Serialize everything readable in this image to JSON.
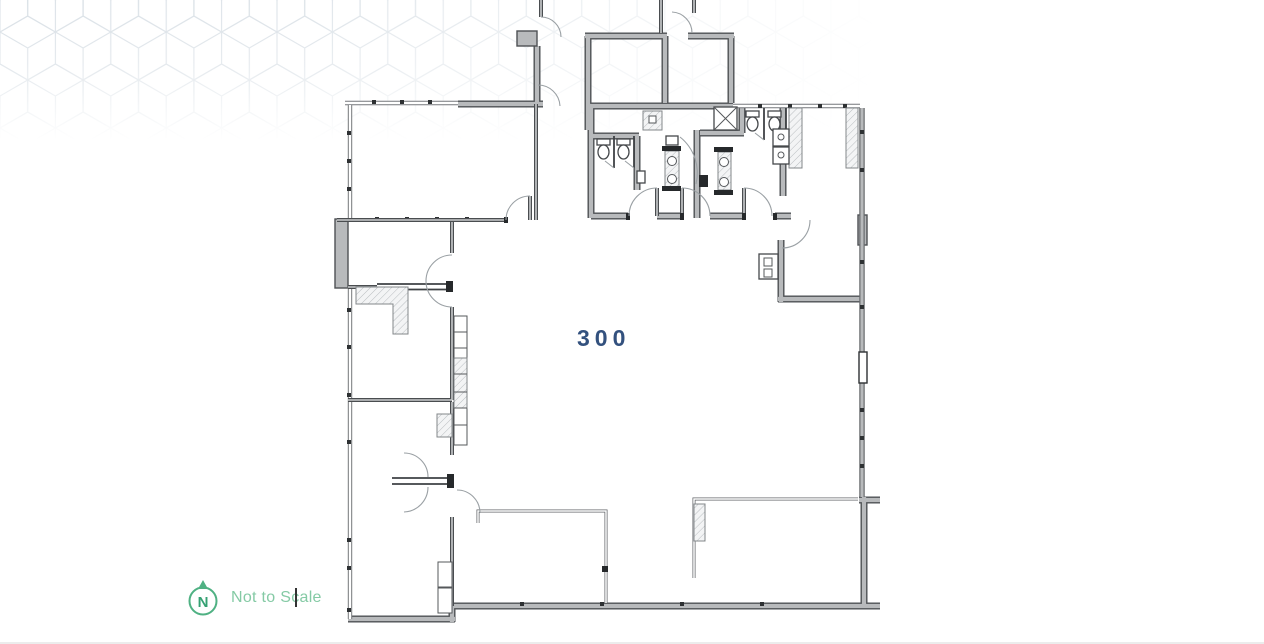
{
  "floor_plan": {
    "unit_label": "300",
    "legend": {
      "north_symbol": "N",
      "note": "Not to Scale"
    },
    "colors": {
      "unit_label": "#33517e",
      "legend_accent": "#4fb183",
      "legend_letter": "#35a173",
      "legend_text": "#85caa5",
      "wall_fill": "#b8babc",
      "wall_edge": "#4e5154",
      "interior_line": "#4a4d50",
      "arc_line": "#9aa0a4",
      "hatch_line": "#c7cbce",
      "pattern_line": "#d9e0e6"
    }
  }
}
